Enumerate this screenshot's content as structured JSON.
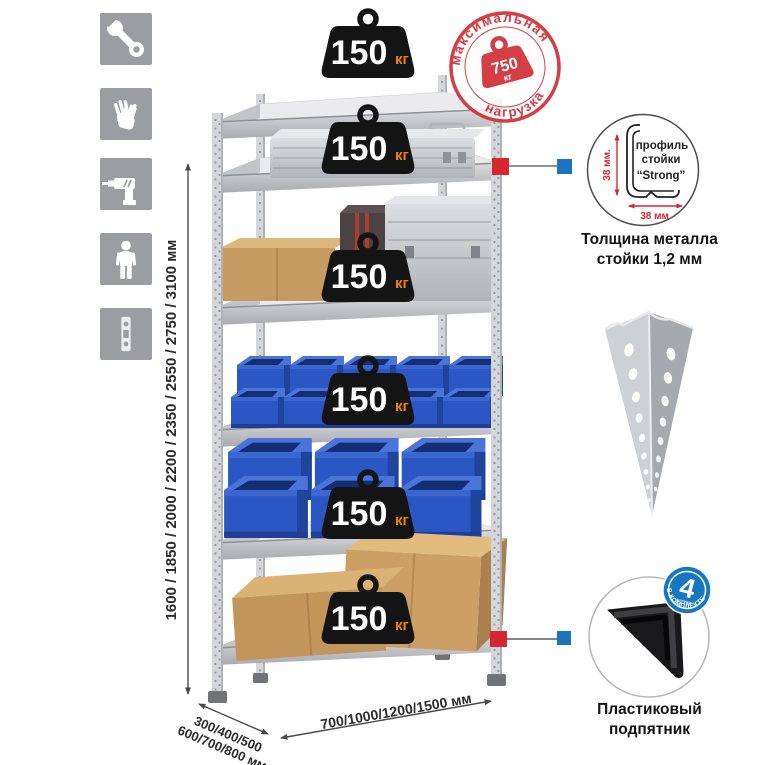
{
  "sidebar": {
    "icons": [
      {
        "name": "wrench-icon"
      },
      {
        "name": "gloves-icon"
      },
      {
        "name": "drill-icon"
      },
      {
        "name": "person-icon"
      },
      {
        "name": "post-profile-icon"
      }
    ]
  },
  "dimensions": {
    "height_label": "1600 / 1850 / 2000 / 2200 / 2350 / 2550 / 2750 / 3100 мм",
    "depth_label_line1": "300/400/500",
    "depth_label_line2": "600/700/800 мм",
    "width_label": "700/1000/1200/1500 мм"
  },
  "shelf": {
    "levels": 6,
    "weight_value": "150",
    "weight_unit": "кг"
  },
  "stamp": {
    "arc_top": "максимальная",
    "arc_bottom": "нагрузка",
    "value": "750",
    "unit": "кг"
  },
  "profile_diagram": {
    "label_line1": "профиль",
    "label_line2": "стойки",
    "label_line3": "“Strong”",
    "vertical_dim": "38 мм.",
    "horizontal_dim": "38 мм.",
    "caption_line1": "Толщина металла",
    "caption_line2": "стойки 1,2 мм"
  },
  "foot": {
    "badge_value": "4",
    "badge_small": "штуки",
    "badge_arc": "В КОМПЛЕКТЕ",
    "caption_line1": "Пластиковый",
    "caption_line2": "подпятник"
  },
  "colors": {
    "accent_red": "#d8262e",
    "stamp_red": "#d2343b",
    "connector_blue": "#1b75bc",
    "badge_blue": "#1778c1",
    "weight_badge_black": "#141414",
    "weight_unit_orange": "#f08300",
    "bin_blue": "#2a57c3",
    "cardboard_tan": "#c79c63",
    "metal_gray": "#d3d4d7",
    "icon_tile_gray": "#9b9da0"
  }
}
